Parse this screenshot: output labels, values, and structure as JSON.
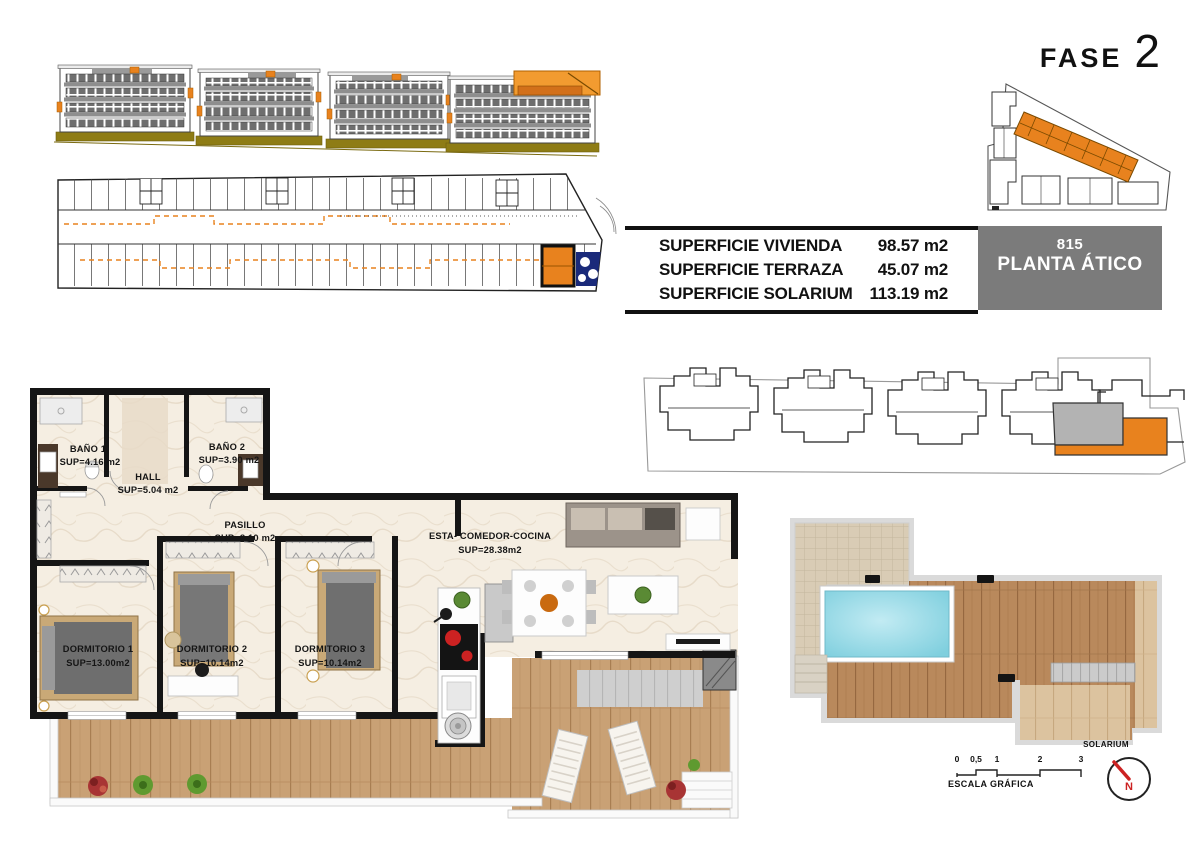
{
  "meta": {
    "fase_label": "FASE",
    "fase_number": "2"
  },
  "unit_box": {
    "number": "815",
    "floor_label": "PLANTA ÁTICO"
  },
  "surface_table": {
    "rows": [
      {
        "label": "SUPERFICIE VIVIENDA",
        "value": "98.57 m2"
      },
      {
        "label": "SUPERFICIE TERRAZA",
        "value": "45.07 m2"
      },
      {
        "label": "SUPERFICIE SOLARIUM",
        "value": "113.19 m2"
      }
    ]
  },
  "plan": {
    "rooms": {
      "bano1": {
        "name": "BAÑO 1",
        "sup": "SUP=4.16 m2"
      },
      "hall": {
        "name": "HALL",
        "sup": "SUP=5.04 m2"
      },
      "bano2": {
        "name": "BAÑO 2",
        "sup": "SUP=3.90 m2"
      },
      "pasillo": {
        "name": "PASILLO",
        "sup": "SUP=8.10 m2"
      },
      "salon": {
        "name": "ESTA- COMEDOR-COCINA",
        "sup": "SUP=28.38m2"
      },
      "dorm1": {
        "name": "DORMITORIO 1",
        "sup": "SUP=13.00m2"
      },
      "dorm2": {
        "name": "DORMITORIO 2",
        "sup": "SUP=10.14m2"
      },
      "dorm3": {
        "name": "DORMITORIO 3",
        "sup": "SUP=10.14m2"
      }
    }
  },
  "solarium": {
    "label": "SOLARIUM"
  },
  "scale_bar": {
    "ticks": [
      "0",
      "0,5",
      "1",
      "2",
      "3"
    ],
    "label": "ESCALA GRÁFICA"
  },
  "compass": {
    "north_letter": "N"
  },
  "colors": {
    "accent_orange": "#E8821E",
    "unit_box_gray": "#7B7B7B",
    "pool_blue": "#85D4E3",
    "terrace_wood": "#C9A175",
    "ground_olive": "#8E7C15",
    "wall_black": "#151515"
  }
}
